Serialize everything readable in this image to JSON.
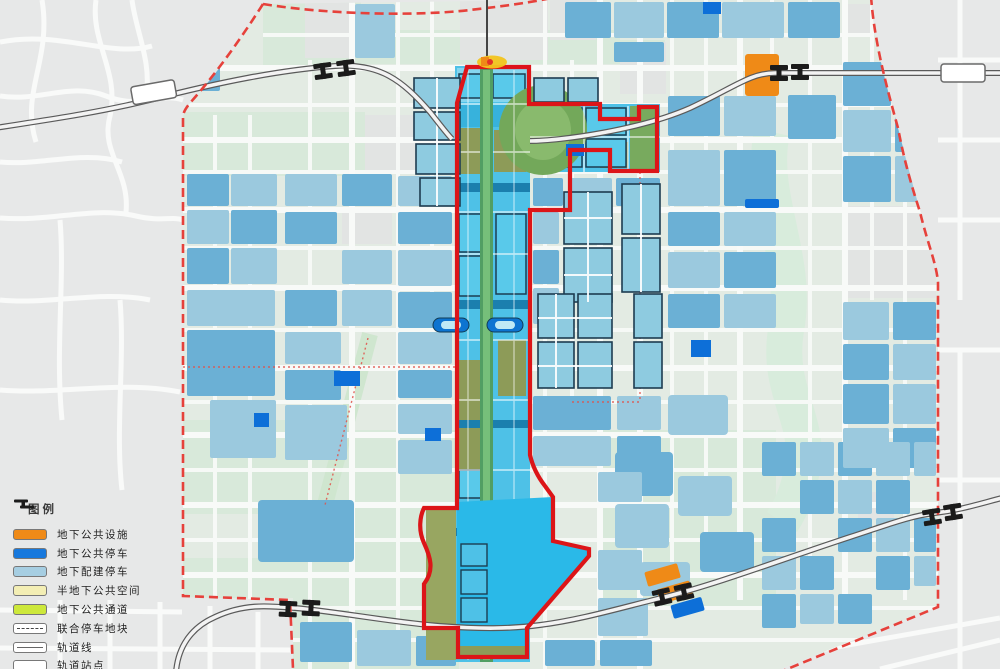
{
  "legend": {
    "title": "图例",
    "items": [
      {
        "id": "underground-public-facility",
        "label": "地下公共设施",
        "color": "#ef8a17",
        "swatch": "fill"
      },
      {
        "id": "underground-public-parking",
        "label": "地下公共停车",
        "color": "#1879dd",
        "swatch": "fill"
      },
      {
        "id": "underground-ancillary-parking",
        "label": "地下配建停车",
        "color": "#a6cee2",
        "swatch": "fill"
      },
      {
        "id": "semi-underground-public-space",
        "label": "半地下公共空间",
        "color": "#f3eeb4",
        "swatch": "fill"
      },
      {
        "id": "underground-public-passage",
        "label": "地下公共通道",
        "color": "#cde83b",
        "swatch": "fill"
      },
      {
        "id": "joint-parking-plot",
        "label": "联合停车地块",
        "color": "#ffffff",
        "swatch": "dashed-box"
      },
      {
        "id": "rail-line",
        "label": "轨道线",
        "color": "#ffffff",
        "swatch": "line-box"
      },
      {
        "id": "rail-station",
        "label": "轨道站点",
        "color": "#ffffff",
        "swatch": "station-icon"
      }
    ]
  },
  "map": {
    "boundary_colors": {
      "site_boundary_solid": "#dc1518",
      "planning_boundary_dashed": "#e6413b"
    },
    "palette": {
      "axis_water_cyan": "#2ab9e8",
      "block_blue_medium": "#6bb0d5",
      "block_blue_light": "#9bc9de",
      "bright_blue_parking": "#0d6fd8",
      "orange_facility": "#ef8a17",
      "park_green": "#73a85a",
      "axis_spine_green": "#519e63",
      "olive_block": "#8d9b58",
      "field_pale_green": "#d8e9da",
      "outside_gray": "#e7e8e8",
      "road_white": "#f8faf8"
    }
  }
}
